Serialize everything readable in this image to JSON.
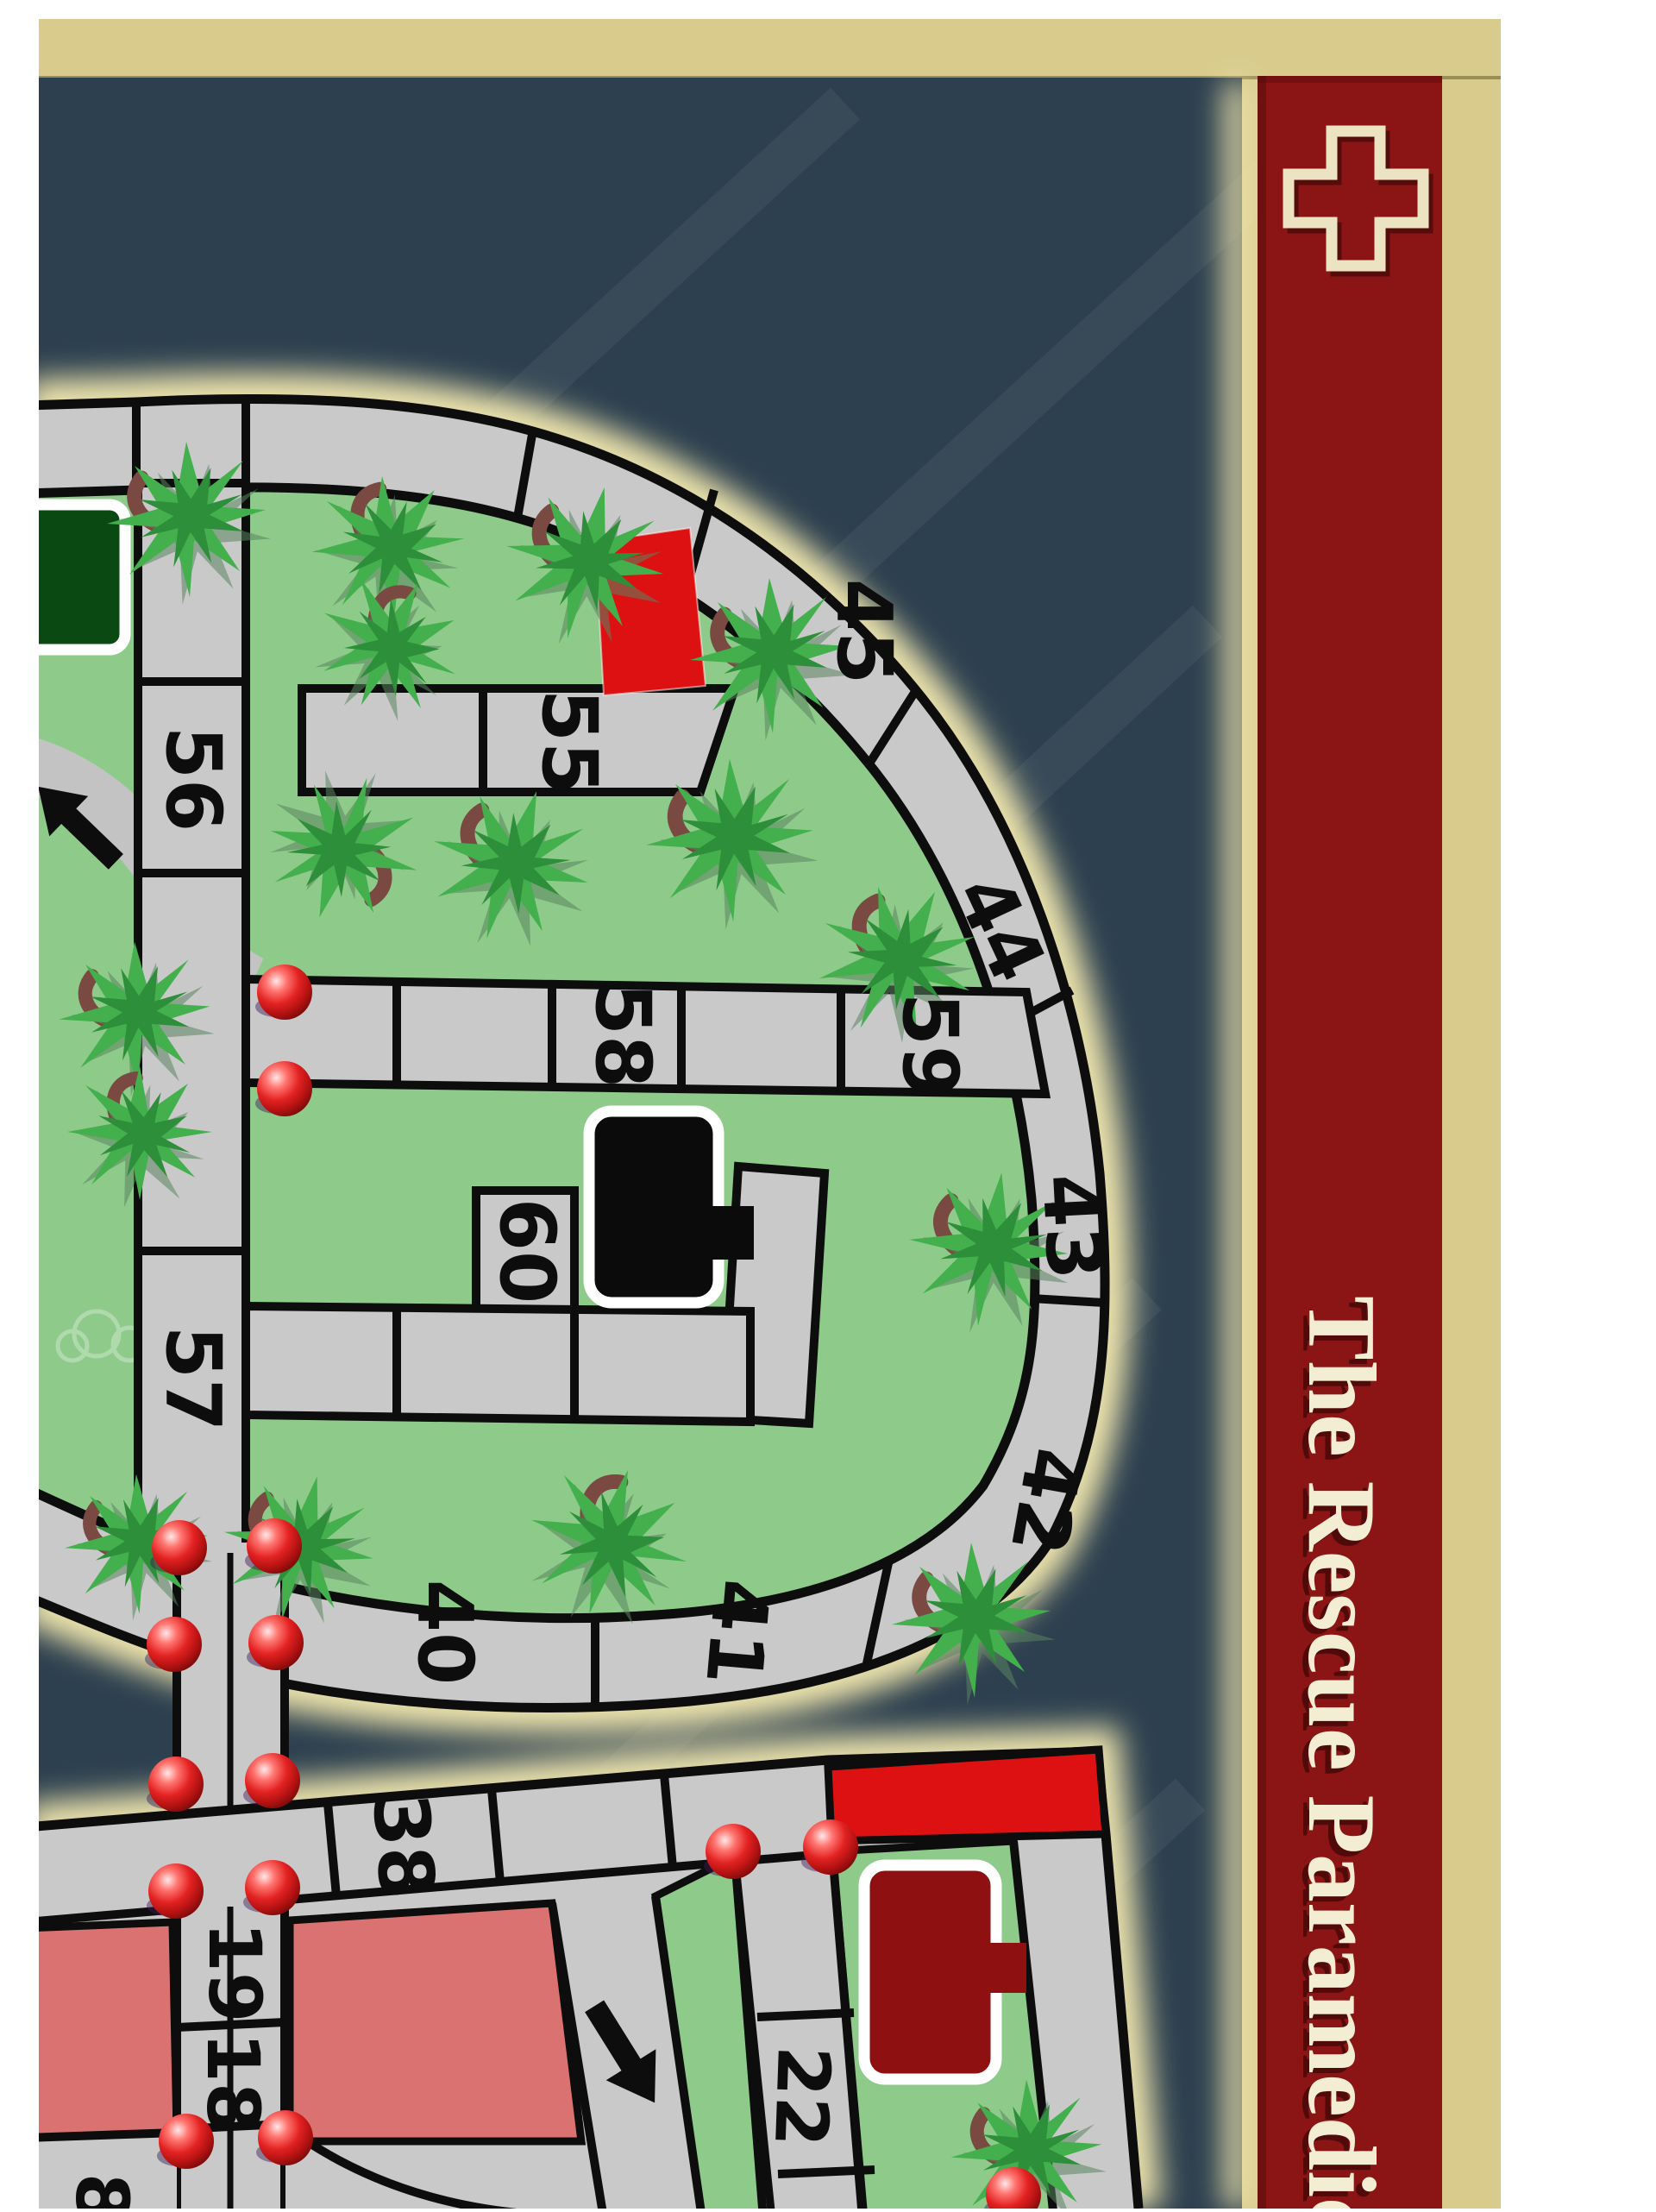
{
  "sidebar": {
    "title": "The Rescue Paramedic",
    "cross_icon": "medical-cross-icon",
    "panel_color": "#8b1414",
    "cream_color": "#ece3c2"
  },
  "board": {
    "spaces": {
      "n45": "45",
      "n55": "55",
      "n56": "56",
      "n44": "44",
      "n58": "58",
      "n59": "59",
      "n43": "43",
      "n60": "60",
      "n57": "57",
      "n42": "42",
      "n41": "41",
      "n40": "40",
      "n38": "38",
      "n19": "19",
      "n18": "18",
      "n8": "8",
      "n22": "22"
    },
    "markers": {
      "stop_ball_count": 15,
      "palm_tree_count": 17,
      "direction_arrow_count": 2
    },
    "pieces": [
      "dark-green-building",
      "black-building",
      "maroon-building",
      "red-lot",
      "red-strip"
    ],
    "colors": {
      "water": "#2d404f",
      "grass": "#8ecb8b",
      "road": "#c9c9c9",
      "outline": "#0d0d0d",
      "beach_glow": "#efe5ad",
      "board_border_tan": "#d8cb8c",
      "zone_pink": "#db7272",
      "lot_red": "#dd1111",
      "building_maroon": "#8e1010",
      "building_dark_green": "#0a4a12",
      "stop_ball_red": "#e32222"
    }
  }
}
